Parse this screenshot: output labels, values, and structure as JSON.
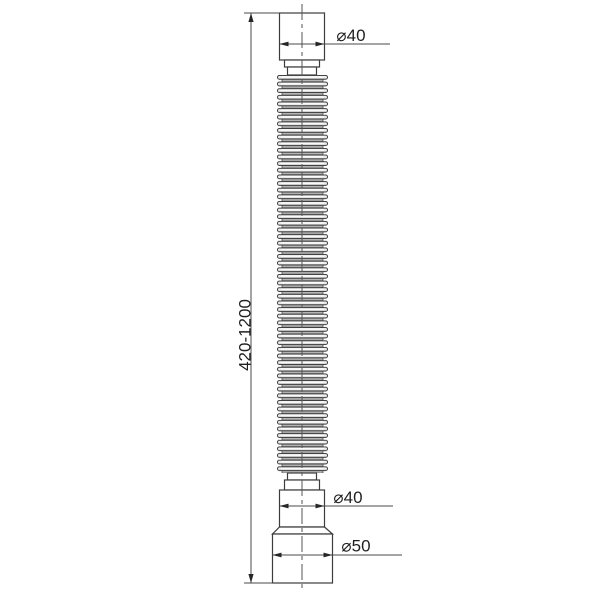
{
  "drawing": {
    "labels": {
      "top_diameter": "⌀40",
      "bottom_diameter": "⌀40",
      "outlet_diameter": "⌀50",
      "length_range": "420-1200"
    },
    "colors": {
      "background": "#ffffff",
      "outline": "#3c3c3c",
      "dimension_line": "#4a4a4a",
      "arrow": "#262626",
      "crest_fill": "#ececec",
      "valley_fill": "#b3b3b3",
      "text": "#1f1f1f"
    }
  }
}
